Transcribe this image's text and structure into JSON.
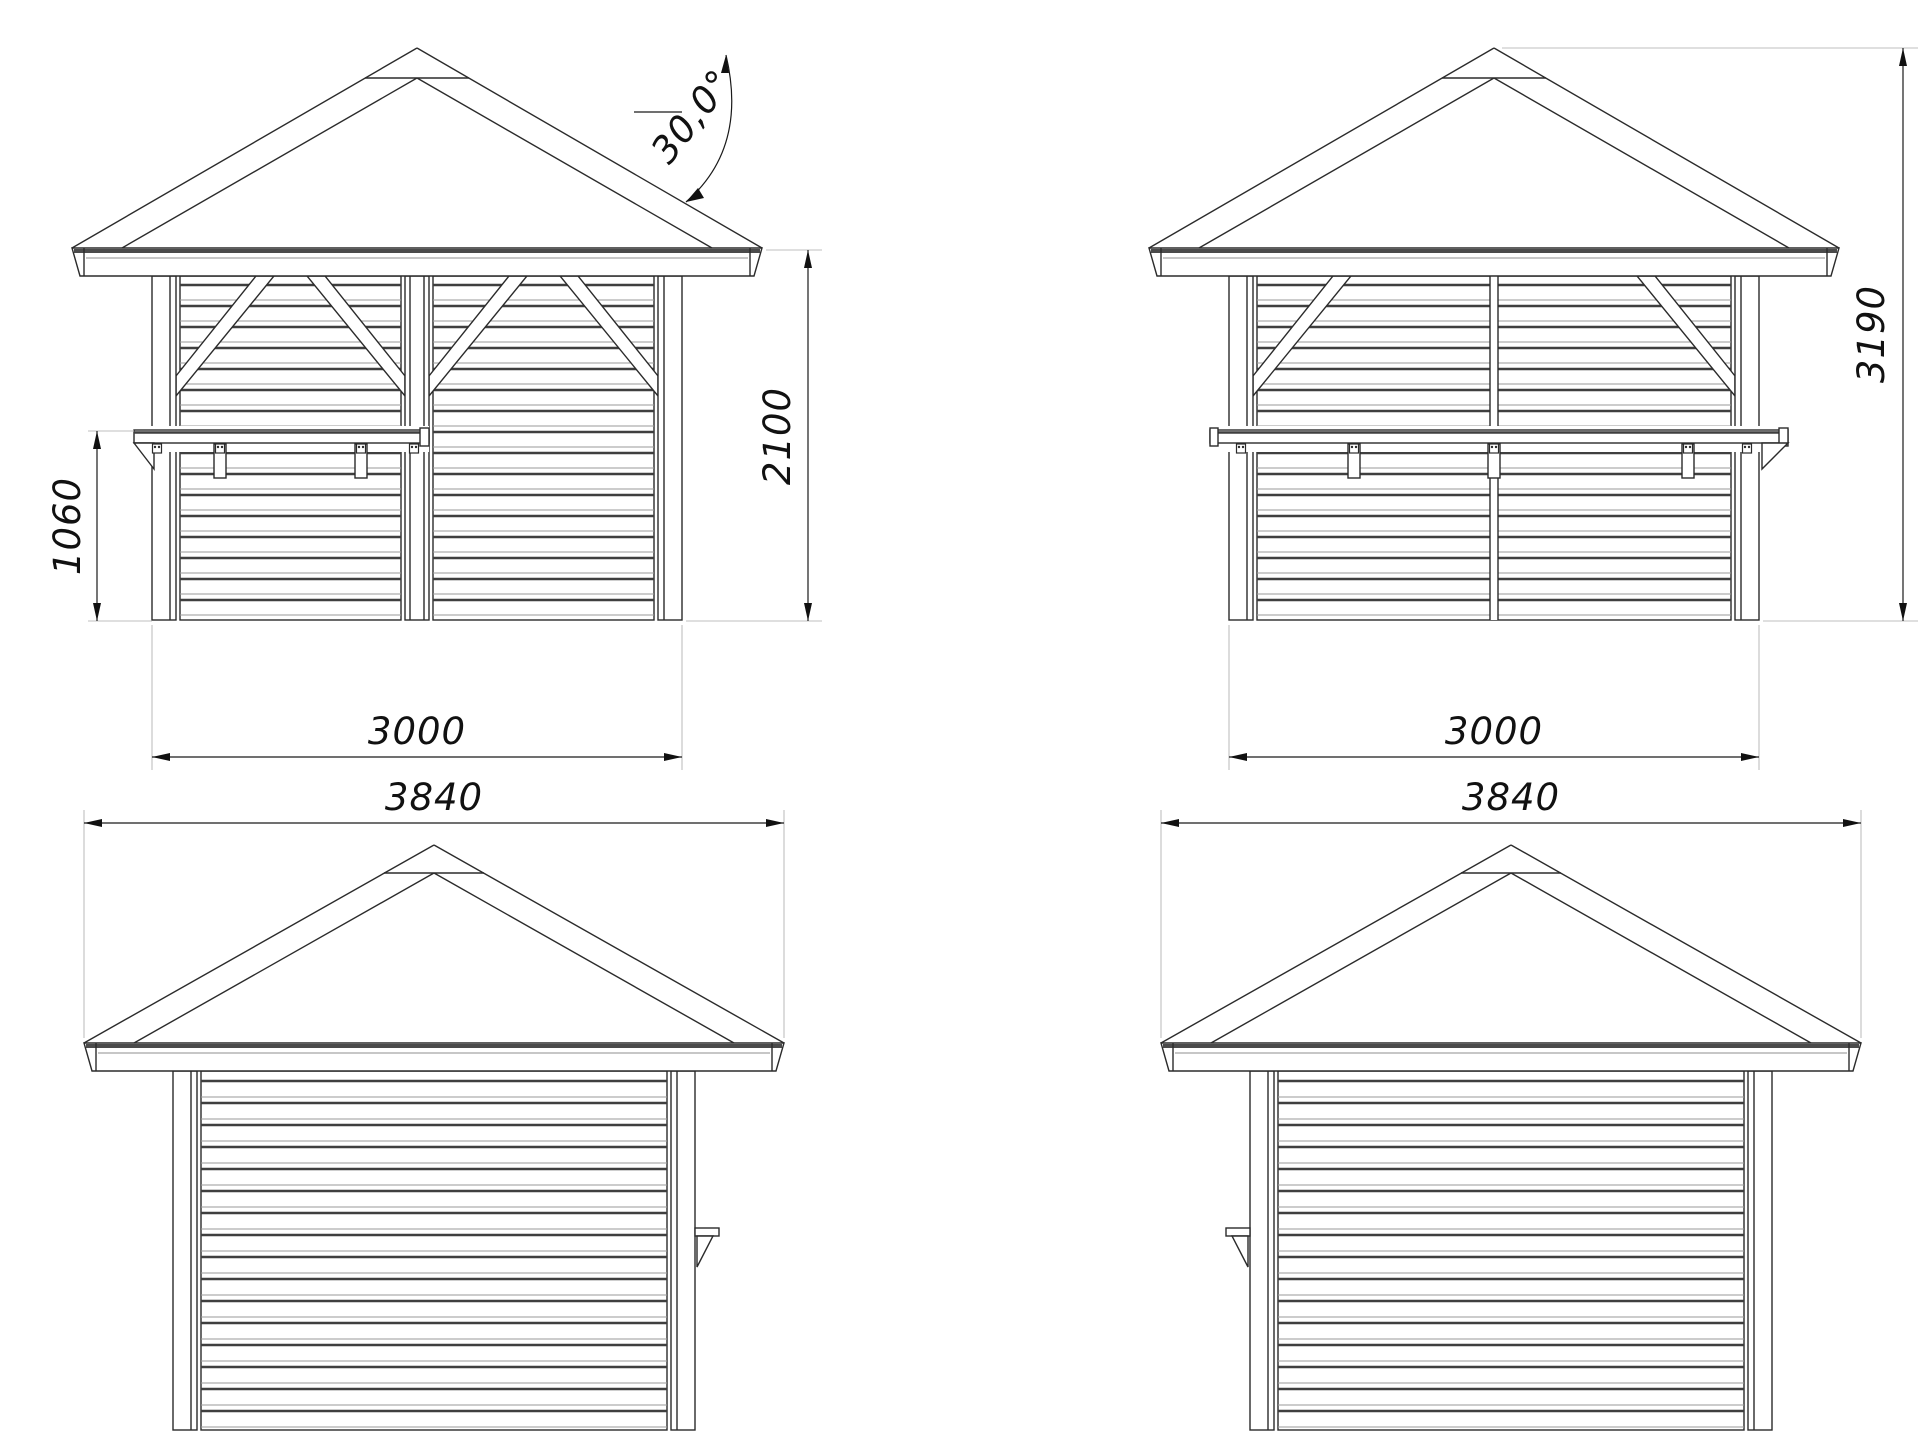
{
  "drawing": {
    "views": {
      "front_a": {
        "dims": {
          "width": "3000",
          "eave_height": "2100",
          "counter_height": "1060",
          "roof_angle": "30,0°"
        }
      },
      "front_b": {
        "dims": {
          "width": "3000",
          "total_height": "3190"
        }
      },
      "side_a": {
        "dims": {
          "roof_width": "3840"
        }
      },
      "side_b": {
        "dims": {
          "roof_width": "3840"
        }
      }
    },
    "colors": {
      "object_line": "#2b2b2b",
      "slat_shadow": "#3f3f3f",
      "extension_line": "#bfbfbf",
      "dimension_line": "#1a1a1a",
      "background": "#ffffff"
    }
  }
}
